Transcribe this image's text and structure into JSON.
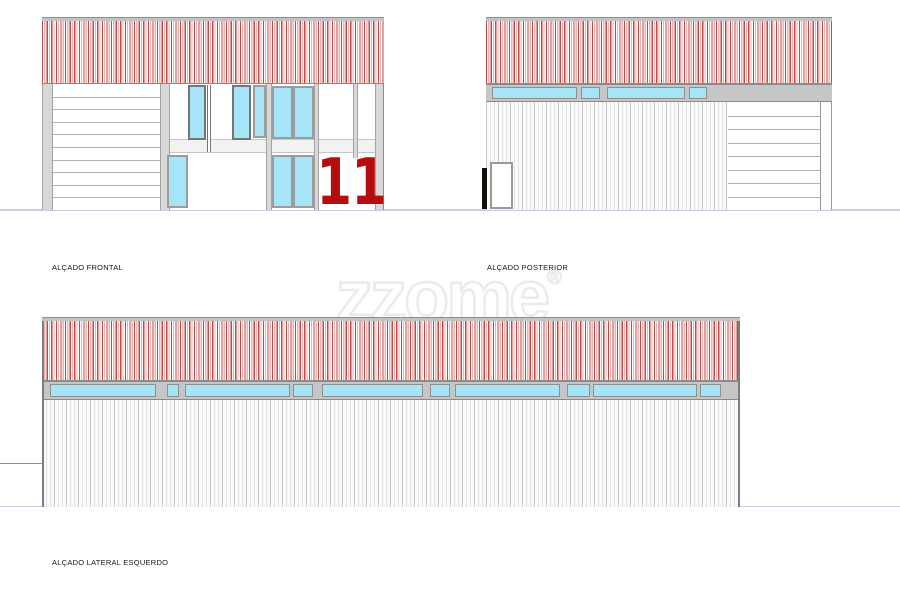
{
  "labels": {
    "frontal": "ALÇADO FRONTAL",
    "posterior": "ALÇADO POSTERIOR",
    "lateral": "ALÇADO LATERAL ESQUERDO"
  },
  "watermark": {
    "text": "zzome",
    "reg": "®"
  },
  "front_elevation": {
    "number": "11",
    "garage_line_count": 9
  },
  "posterior_elevation": {
    "garage_line_count": 7,
    "band_segments": [
      {
        "x": 6,
        "w": 85
      },
      {
        "x": 95,
        "w": 19
      },
      {
        "x": 121,
        "w": 78
      },
      {
        "x": 203,
        "w": 18
      }
    ]
  },
  "lateral_elevation": {
    "band_segments": [
      {
        "x": 8,
        "w": 106
      },
      {
        "x": 125,
        "w": 12
      },
      {
        "x": 143,
        "w": 105
      },
      {
        "x": 251,
        "w": 20
      },
      {
        "x": 280,
        "w": 101
      },
      {
        "x": 388,
        "w": 20
      },
      {
        "x": 413,
        "w": 105
      },
      {
        "x": 525,
        "w": 23
      },
      {
        "x": 551,
        "w": 104
      },
      {
        "x": 658,
        "w": 21
      }
    ]
  },
  "colors": {
    "stripe_red": "#bf4a47",
    "stripe_pink": "#eab4b2",
    "glass_cyan": "#a6e4f7",
    "frame_gray": "#9c9c9c",
    "frame_dark": "#757575",
    "pilaster_gray": "#d8d8d8",
    "band_gray": "#c6c6c6",
    "roofbar_gray": "#c3c3c3",
    "number_red": "#b50d0d",
    "ground_line": "#ccccea",
    "watermark_gray": "#ebebeb"
  }
}
